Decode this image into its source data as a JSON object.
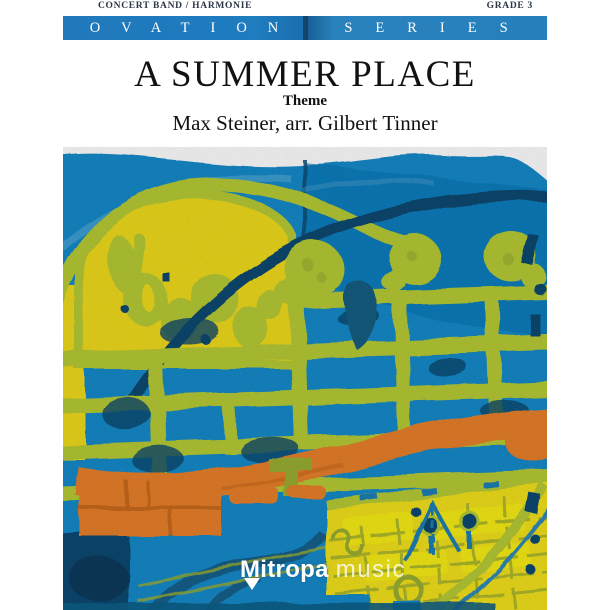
{
  "header": {
    "category": "CONCERT BAND / HARMONIE",
    "grade": "GRADE 3"
  },
  "series_bar": {
    "left": "OVATION",
    "right": "SERIES"
  },
  "title_block": {
    "title": "A SUMMER PLACE",
    "subtitle": "Theme",
    "credits": "Max Steiner, arr. Gilbert Tinner"
  },
  "publisher_logo": {
    "name_bold": "Mitropa",
    "name_light": "music"
  },
  "artwork_palette": {
    "bar_blue": "#1F7CBE",
    "azure": "#168ACA",
    "deep_blue": "#0E77B4",
    "navy": "#0D4A6F",
    "teal": "#135E82",
    "chartreuse": "#B7CB35",
    "olive": "#9AAE33",
    "yellow": "#F0DB1F",
    "bright_yellow": "#F2E11C",
    "orange": "#E8802B",
    "text_dark": "#2A3644"
  }
}
